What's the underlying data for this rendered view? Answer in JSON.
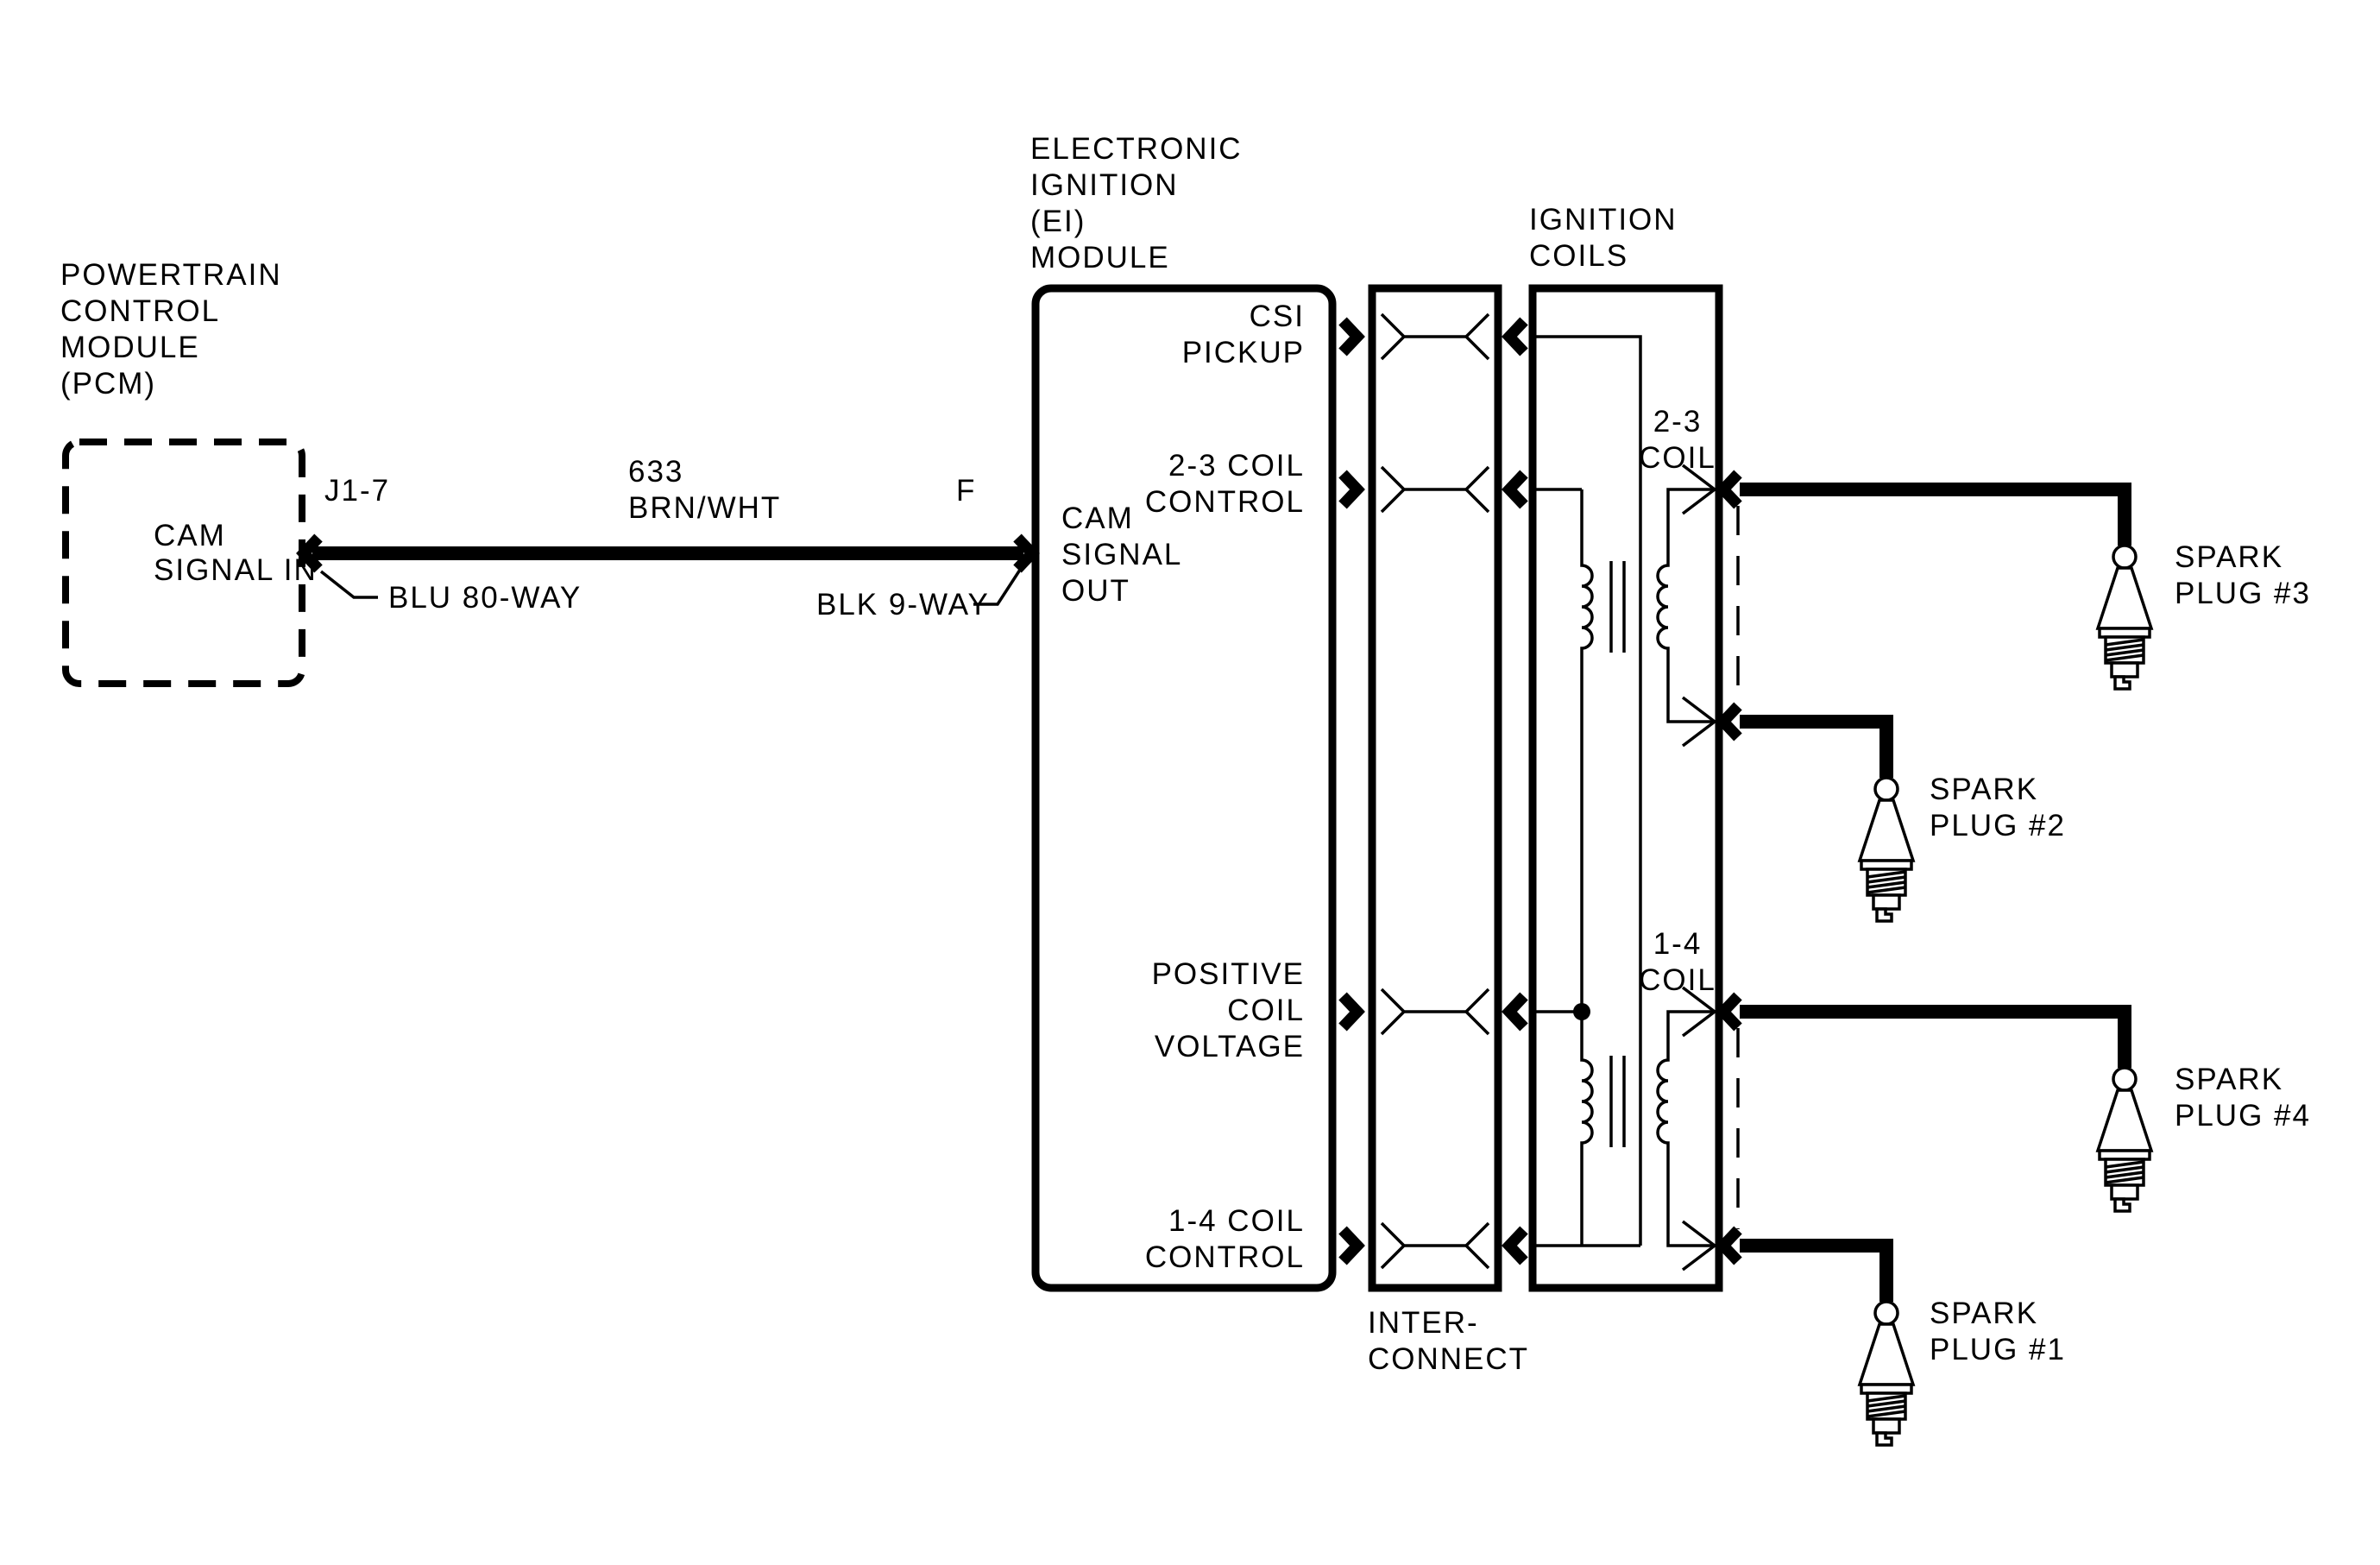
{
  "colors": {
    "ink": "#000000",
    "paper": "#ffffff"
  },
  "pcm": {
    "title": [
      "POWERTRAIN",
      "CONTROL",
      "MODULE",
      "(PCM)"
    ],
    "signal": [
      "CAM",
      "SIGNAL IN"
    ],
    "pin_label": "J1-7",
    "connector_label": "BLU 80-WAY"
  },
  "wire": {
    "circuit_number": "633",
    "color_code": "BRN/WHT",
    "pin_label": "F",
    "connector_label": "BLK 9-WAY"
  },
  "ei_module": {
    "title": [
      "ELECTRONIC",
      "IGNITION",
      "(EI)",
      "MODULE"
    ],
    "cam_signal_out": [
      "CAM",
      "SIGNAL",
      "OUT"
    ],
    "csi_pickup": [
      "CSI",
      "PICKUP"
    ],
    "coil_23_control": [
      "2-3 COIL",
      "CONTROL"
    ],
    "positive_coil_voltage": [
      "POSITIVE",
      "COIL",
      "VOLTAGE"
    ],
    "coil_14_control": [
      "1-4 COIL",
      "CONTROL"
    ]
  },
  "interconnect": {
    "label": [
      "INTER-",
      "CONNECT"
    ]
  },
  "ignition_coils": {
    "title": [
      "IGNITION",
      "COILS"
    ],
    "coil_23": [
      "2-3",
      "COIL"
    ],
    "coil_14": [
      "1-4",
      "COIL"
    ]
  },
  "spark_plugs": {
    "plug3": [
      "SPARK",
      "PLUG #3"
    ],
    "plug2": [
      "SPARK",
      "PLUG #2"
    ],
    "plug4": [
      "SPARK",
      "PLUG #4"
    ],
    "plug1": [
      "SPARK",
      "PLUG #1"
    ]
  }
}
